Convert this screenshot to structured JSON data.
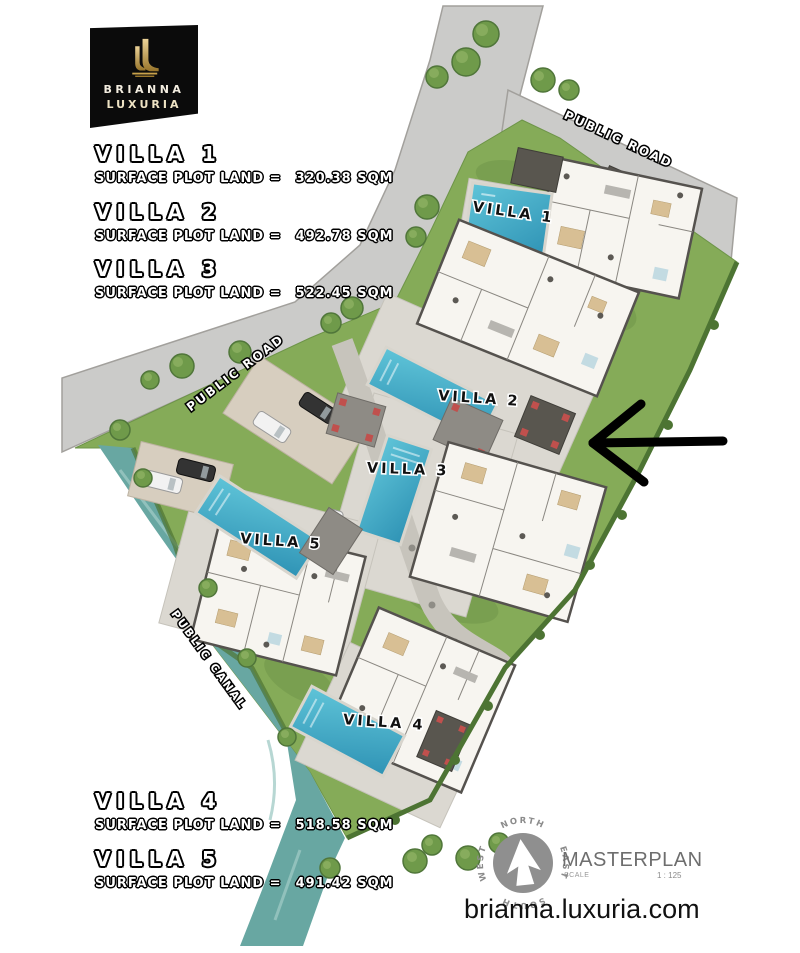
{
  "logo": {
    "brand_top": "BRIANNA",
    "brand_bottom": "LUXURIA"
  },
  "panel": {
    "entries": [
      {
        "name": "VILLA 1",
        "surface_label": "SURFACE PLOT LAND =",
        "area": "320.38 SQM"
      },
      {
        "name": "VILLA 2",
        "surface_label": "SURFACE PLOT LAND =",
        "area": "492.78 SQM"
      },
      {
        "name": "VILLA 3",
        "surface_label": "SURFACE PLOT LAND =",
        "area": "522.45 SQM"
      },
      {
        "name": "VILLA 4",
        "surface_label": "SURFACE PLOT LAND =",
        "area": "518.58 SQM"
      },
      {
        "name": "VILLA 5",
        "surface_label": "SURFACE PLOT LAND =",
        "area": "491.42 SQM"
      }
    ]
  },
  "map": {
    "villas": [
      "VILLA 1",
      "VILLA 2",
      "VILLA 3",
      "VILLA 4",
      "VILLA 5"
    ],
    "public_road_top": "PUBLIC ROAD",
    "public_road_left": "PUBLIC ROAD",
    "public_canal": "PUBLIC CANAL"
  },
  "compass": {
    "north": "NORTH",
    "east": "EAST",
    "south": "SOUTH",
    "west": "WEST"
  },
  "footer": {
    "masterplan": "MASTERPLAN",
    "scale_label": "SCALE",
    "scale_ratio": "1 : 125",
    "website": "brianna.luxuria.com"
  },
  "colors": {
    "logo_gold": "#c9a24b",
    "logo_black": "#0b0b0b",
    "pool_blue": "#45b0c9",
    "canal_teal": "#68a7a2",
    "lawn_green": "#85ab58",
    "road_gray": "#cbcbc9",
    "annotation_black": "#000000"
  }
}
